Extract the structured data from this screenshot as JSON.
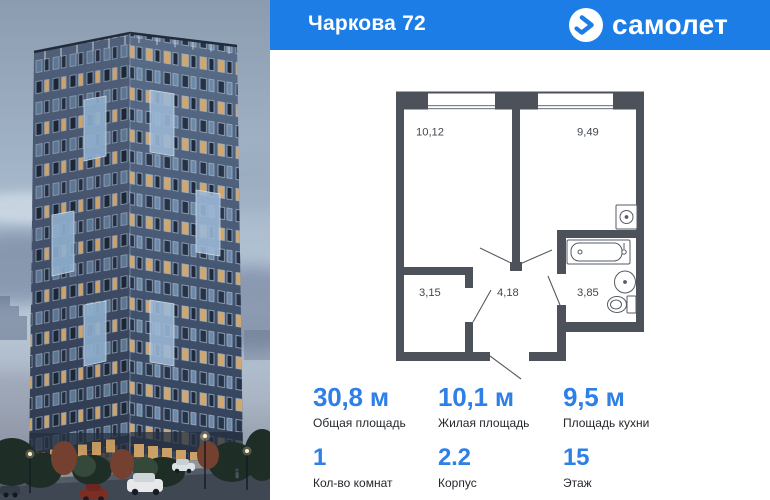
{
  "header": {
    "title": "Чаркова 72",
    "brand": "самолет"
  },
  "floorplan": {
    "rooms": [
      {
        "id": "room-main",
        "area": "10,12"
      },
      {
        "id": "room-second",
        "area": "9,49"
      },
      {
        "id": "wardrobe",
        "area": "3,15"
      },
      {
        "id": "hallway",
        "area": "4,18"
      },
      {
        "id": "bathroom",
        "area": "3,85"
      }
    ]
  },
  "stats": {
    "primary": [
      {
        "value": "30,8 м",
        "label": "Общая площадь"
      },
      {
        "value": "10,1 м",
        "label": "Жилая площадь"
      },
      {
        "value": "9,5 м",
        "label": "Площадь кухни"
      }
    ],
    "secondary": [
      {
        "value": "1",
        "label": "Кол-во комнат"
      },
      {
        "value": "2.2",
        "label": "Корпус"
      },
      {
        "value": "15",
        "label": "Этаж"
      }
    ]
  },
  "colors": {
    "header_blue": "#1d7de6",
    "accent_blue": "#2e7fe6",
    "wall_gray": "#4d525a"
  }
}
